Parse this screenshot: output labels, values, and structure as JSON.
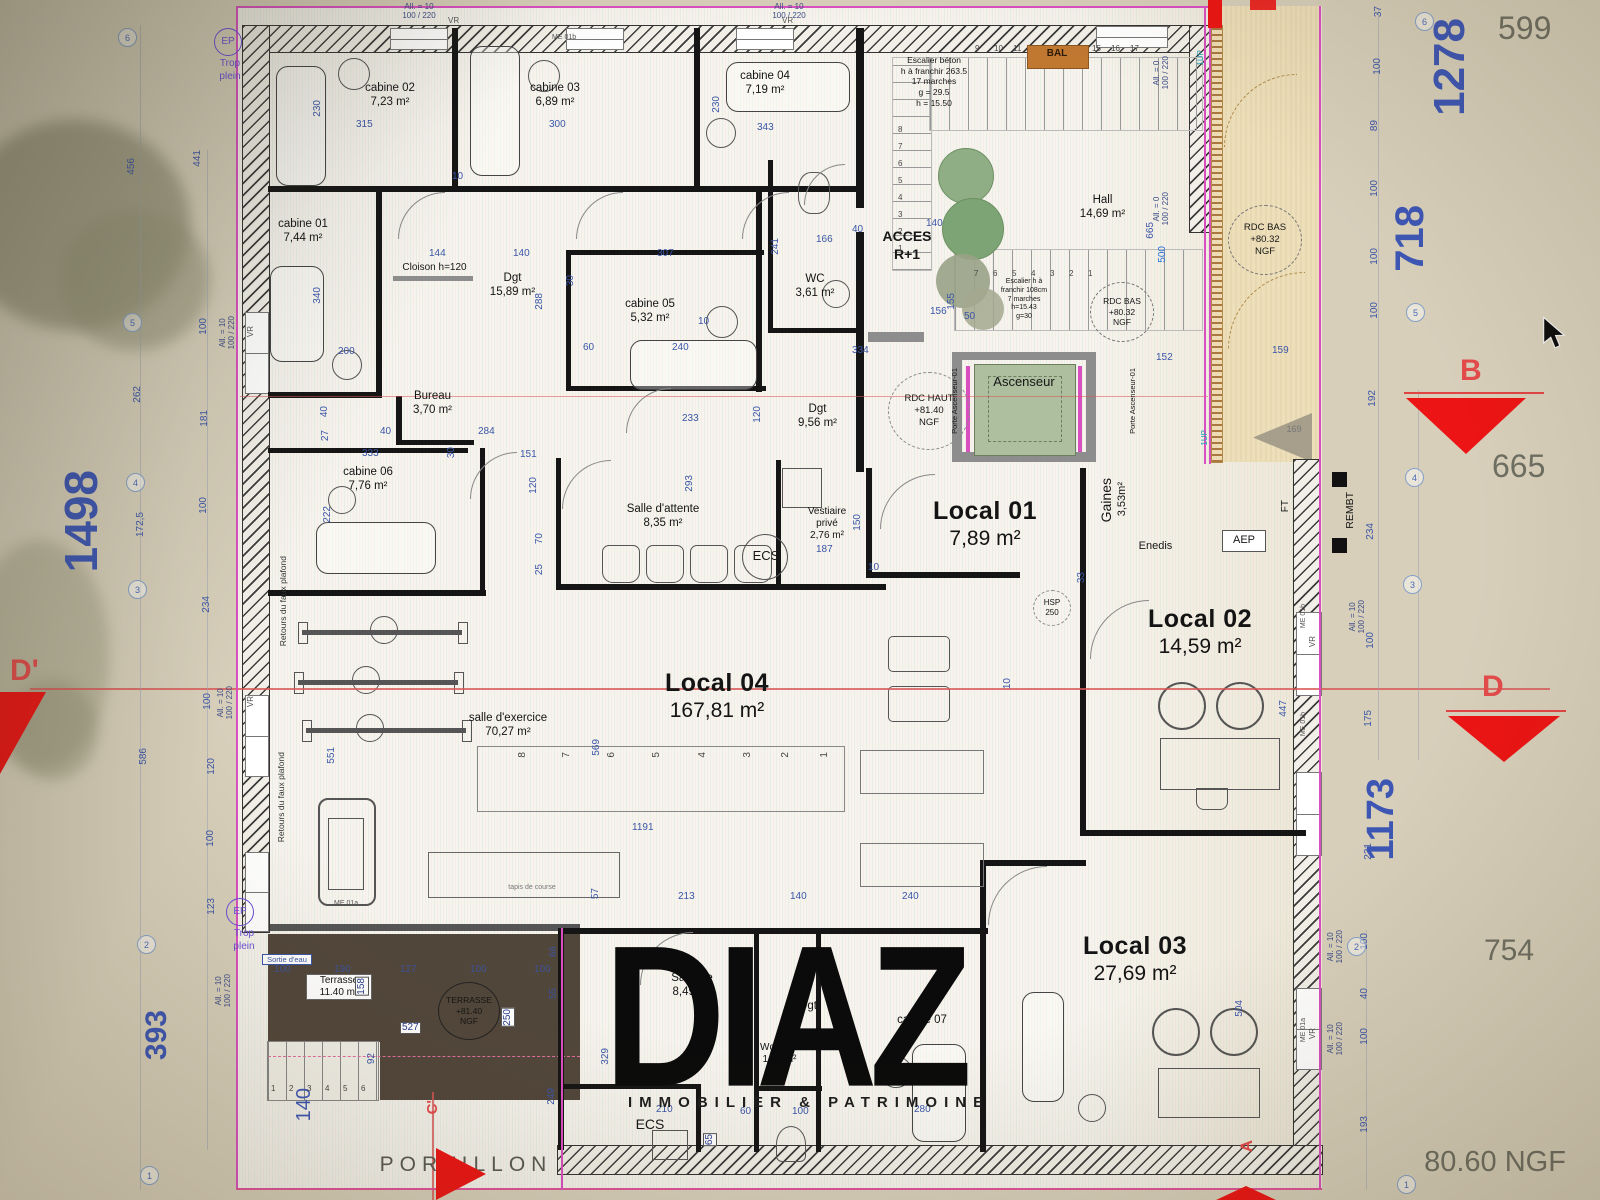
{
  "watermark": {
    "brand": "DIAZ",
    "tagline": "IMMOBILIER & PATRIMOINE"
  },
  "rooms": {
    "cabine01": {
      "name": "cabine 01",
      "area": "7,44 m²"
    },
    "cabine02": {
      "name": "cabine 02",
      "area": "7,23 m²"
    },
    "cabine03": {
      "name": "cabine 03",
      "area": "6,89 m²"
    },
    "cabine04": {
      "name": "cabine 04",
      "area": "7,19 m²"
    },
    "cabine05": {
      "name": "cabine 05",
      "area": "5,32 m²"
    },
    "cabine06": {
      "name": "cabine 06",
      "area": "7,76 m²"
    },
    "cabine07": {
      "name": "cabine 07",
      "area": ""
    },
    "bureau": {
      "name": "Bureau",
      "area": "3,70 m²"
    },
    "dgt1": {
      "name": "Dgt",
      "area": "15,89 m²"
    },
    "dgt2": {
      "name": "Dgt",
      "area": "9,56 m²"
    },
    "dgt3": {
      "name": "Dgt",
      "area": ""
    },
    "wc": {
      "name": "WC",
      "area": "3,61 m²"
    },
    "hall": {
      "name": "Hall",
      "area": "14,69 m²"
    },
    "local01": {
      "name": "Local 01",
      "area": "7,89 m²"
    },
    "local02": {
      "name": "Local 02",
      "area": "14,59 m²"
    },
    "local03": {
      "name": "Local 03",
      "area": "27,69 m²"
    },
    "local04": {
      "name": "Local 04",
      "area": "167,81 m²"
    },
    "attente": {
      "name": "Salle d'attente",
      "area": "8,35 m²"
    },
    "vestiaire": {
      "name": "Vestiaire\nprivé",
      "area": "2,76 m²"
    },
    "exercice": {
      "name": "salle d'exercice",
      "area": "70,27 m²"
    },
    "gaines": {
      "name": "Gaines",
      "area": "3,53m²"
    },
    "terrasse": {
      "name": "Terrasse",
      "area": "11.40 m²"
    },
    "salle_de": {
      "name": "Salle de",
      "area": "8,49 m²"
    },
    "wc_prive": {
      "name": "Wc privé",
      "area": "1,64 m²"
    }
  },
  "ann": {
    "cloison": "Cloison h=120",
    "esc1": "Escalier béton\nh à franchir 263.5\n17 marches\ng = 29.5\nh = 15.50",
    "esc2": "Escalier h à\nfranchir 108cm\n7 marches\nh=15.43\ng=30",
    "acces": "ACCES\nR+1",
    "rdcbas": "RDC BAS\n+80.32\nNGF",
    "rdchaut": "RDC HAUT\n+81.40\nNGF",
    "terrngf": "TERRASSE\n+81.40\nNGF",
    "asc": "Ascenseur",
    "porte": "Porte Ascenseur-01",
    "bal": "BAL",
    "ecs": "ECS",
    "enedis": "Enedis",
    "aep": "AEP",
    "ft": "FT",
    "hsp": "HSP\n250",
    "rembt": "REMBT",
    "retours": "Retours du faux plafond",
    "sortie": "Sortie d'eau",
    "ep": "EP",
    "trop": "Trop\nplein",
    "portillon": "PORTILLON",
    "tapis": "tapis de course",
    "vr": "VR",
    "all10": "All. = 10\n100 / 220",
    "all0": "All. = 0\n100 / 220",
    "me01b": "ME 01b",
    "me01a": "ME 01a",
    "up1": "1UP",
    "n169": "169"
  },
  "markers": {
    "b": "B",
    "d": "D",
    "dp": "D'",
    "cp": "C'",
    "a": "A"
  },
  "bigdims": {
    "v1498": "1498",
    "v393": "393",
    "v1278": "1278",
    "v718": "718",
    "v1173": "1173",
    "g599": "599",
    "g665": "665",
    "g754": "754",
    "gngf": "80.60 NGF",
    "v140": "140"
  },
  "dims": {
    "top": [
      "315",
      "300",
      "343",
      "230",
      "230",
      "10",
      "144",
      "140",
      "307",
      "30"
    ],
    "c1": [
      "240",
      "233",
      "60",
      "288",
      "334",
      "152",
      "159",
      "155",
      "50",
      "156",
      "140",
      "166",
      "40",
      "241",
      "120",
      "10",
      "665",
      "500"
    ],
    "c2": [
      "333",
      "27",
      "40",
      "40",
      "284",
      "151",
      "30",
      "222",
      "200",
      "340",
      "70",
      "25",
      "293",
      "150",
      "187",
      "10",
      "120"
    ],
    "c3": [
      "551",
      "569",
      "1191",
      "213",
      "57",
      "140",
      "240",
      "210",
      "60",
      "100",
      "280",
      "65",
      "329",
      "92",
      "249",
      "447",
      "504",
      "33",
      "10"
    ],
    "terr": [
      "158",
      "527",
      "250",
      "100",
      "190",
      "127",
      "100",
      "100",
      "66",
      "55"
    ],
    "right": [
      "37",
      "100",
      "89",
      "100",
      "100",
      "100",
      "192",
      "234",
      "100",
      "175",
      "231",
      "100",
      "40",
      "100",
      "193"
    ],
    "left": [
      "456",
      "441",
      "262",
      "181",
      "172,5",
      "100",
      "234",
      "100",
      "586",
      "120",
      "100",
      "123",
      "100"
    ]
  },
  "bubbles": {
    "left": [
      "6",
      "5",
      "4",
      "3",
      "2",
      "1"
    ],
    "right": [
      "6",
      "5",
      "4",
      "3",
      "2",
      "1"
    ]
  },
  "stairs": {
    "top": [
      "9",
      "10",
      "11",
      "15",
      "16",
      "17"
    ],
    "left": [
      "8",
      "7",
      "6",
      "5",
      "4",
      "3",
      "2",
      "1"
    ],
    "low": [
      "7",
      "6",
      "5",
      "4",
      "3",
      "2",
      "1"
    ],
    "steps": [
      "1",
      "2",
      "3",
      "4",
      "5",
      "6"
    ],
    "mat": [
      "8",
      "7",
      "6",
      "5",
      "4",
      "3",
      "2",
      "1"
    ]
  }
}
